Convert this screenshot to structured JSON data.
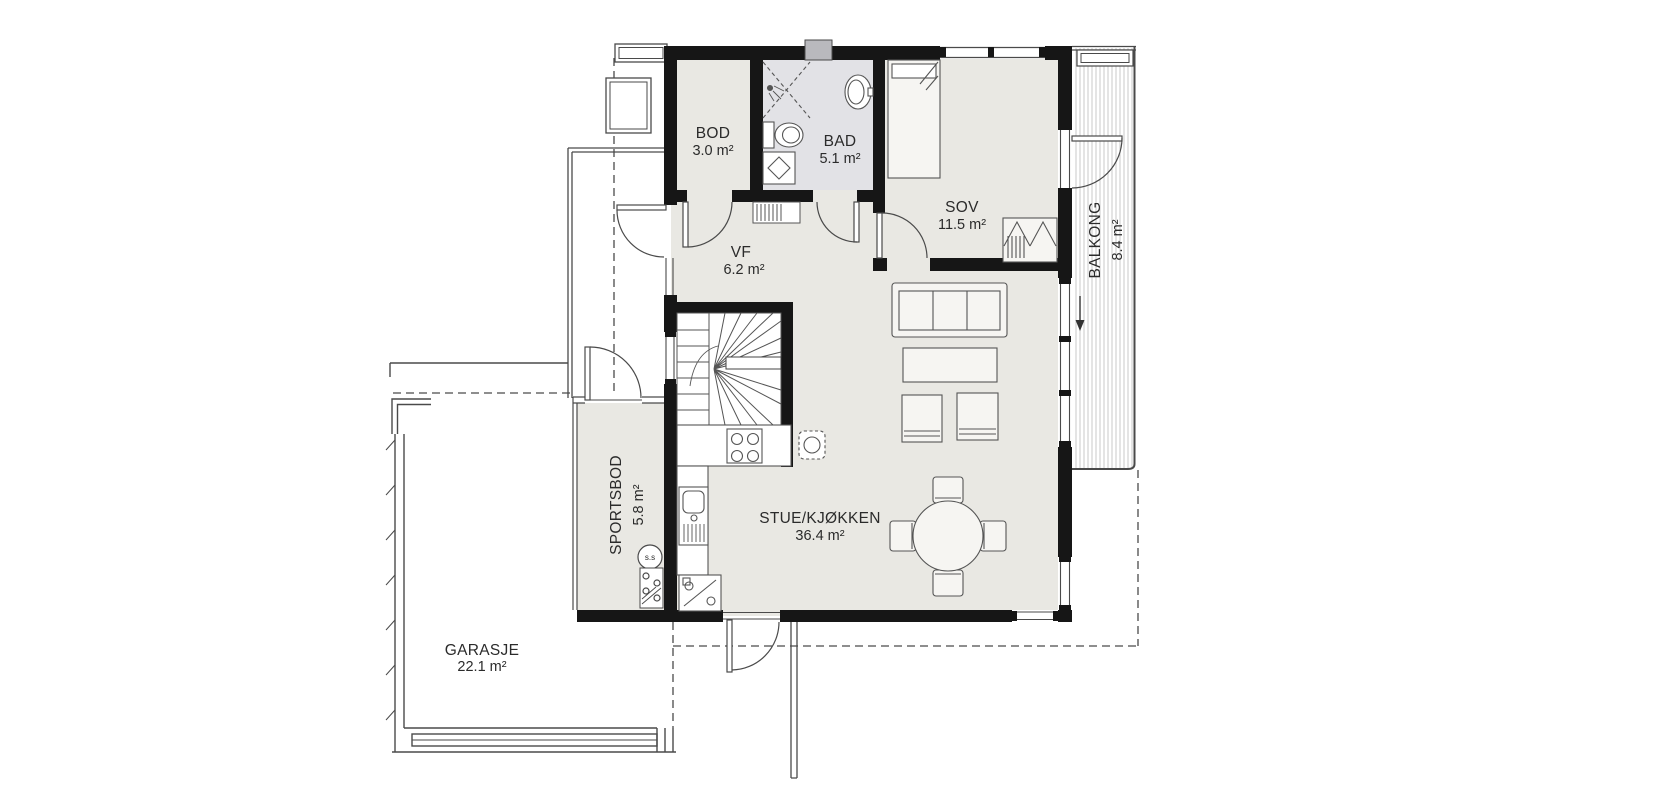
{
  "plan": {
    "rooms": [
      {
        "name": "BOD",
        "area": "3.0 m²"
      },
      {
        "name": "BAD",
        "area": "5.1 m²"
      },
      {
        "name": "SOV",
        "area": "11.5 m²"
      },
      {
        "name": "VF",
        "area": "6.2 m²"
      },
      {
        "name": "STUE/KJØKKEN",
        "area": "36.4 m²"
      },
      {
        "name": "SPORTSBOD",
        "area": "5.8 m²"
      },
      {
        "name": "BALKONG",
        "area": "8.4 m²"
      },
      {
        "name": "GARASJE",
        "area": "22.1 m²"
      }
    ],
    "annotations": {
      "water_heater": "s.s"
    },
    "colors": {
      "wall": "#161616",
      "floor": "#e9e8e3",
      "bathroom_floor": "#e2e2e6",
      "window_glass": "#b9b9bd",
      "line": "#4a4a4a",
      "hatch": "#c9c9c9",
      "background": "#ffffff"
    }
  }
}
